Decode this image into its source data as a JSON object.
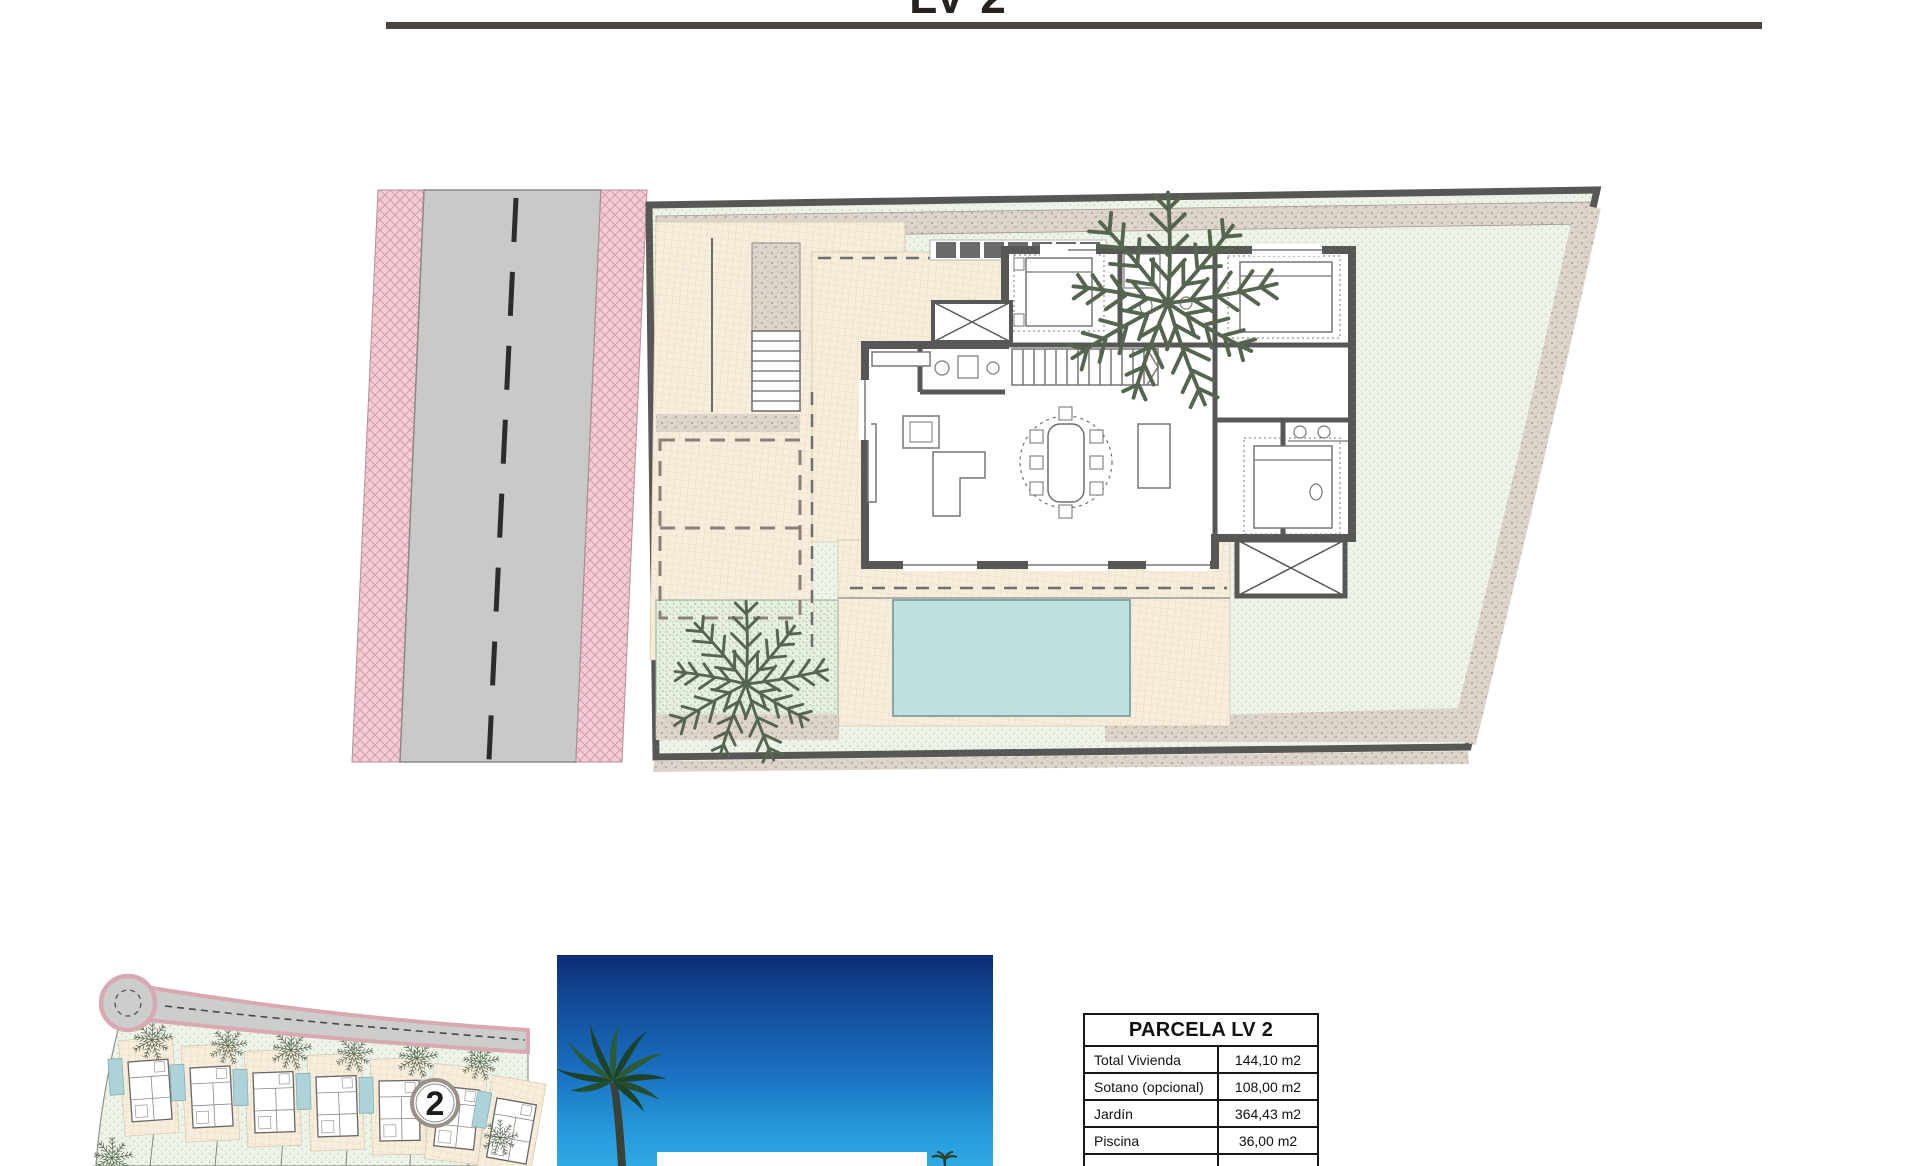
{
  "header": {
    "title": "LV 2"
  },
  "site_plan": {
    "highlighted_plot_label": "2"
  },
  "area_table": {
    "title": "PARCELA LV 2",
    "rows": [
      {
        "label": "Total Vivienda",
        "value": "144,10 m2"
      },
      {
        "label": "Sotano (opcional)",
        "value": "108,00 m2"
      },
      {
        "label": "Jardín",
        "value": "364,43 m2"
      },
      {
        "label": "Piscina",
        "value": "36,00 m2"
      }
    ]
  },
  "icons": {
    "palm_plan": "palm-tree-icon",
    "palm_photo": "palm-tree-silhouette-icon"
  },
  "colors": {
    "pool": "#bfe0df",
    "lawn": "#eef3e9",
    "terrace": "#f7eddc",
    "sidewalk_pink": "#f3cbd2",
    "asphalt": "#c9c9c7",
    "wall": "#575755",
    "sky_top": "#0d2d75",
    "sky_bottom": "#2fa9e4",
    "rule": "#4b433d"
  }
}
